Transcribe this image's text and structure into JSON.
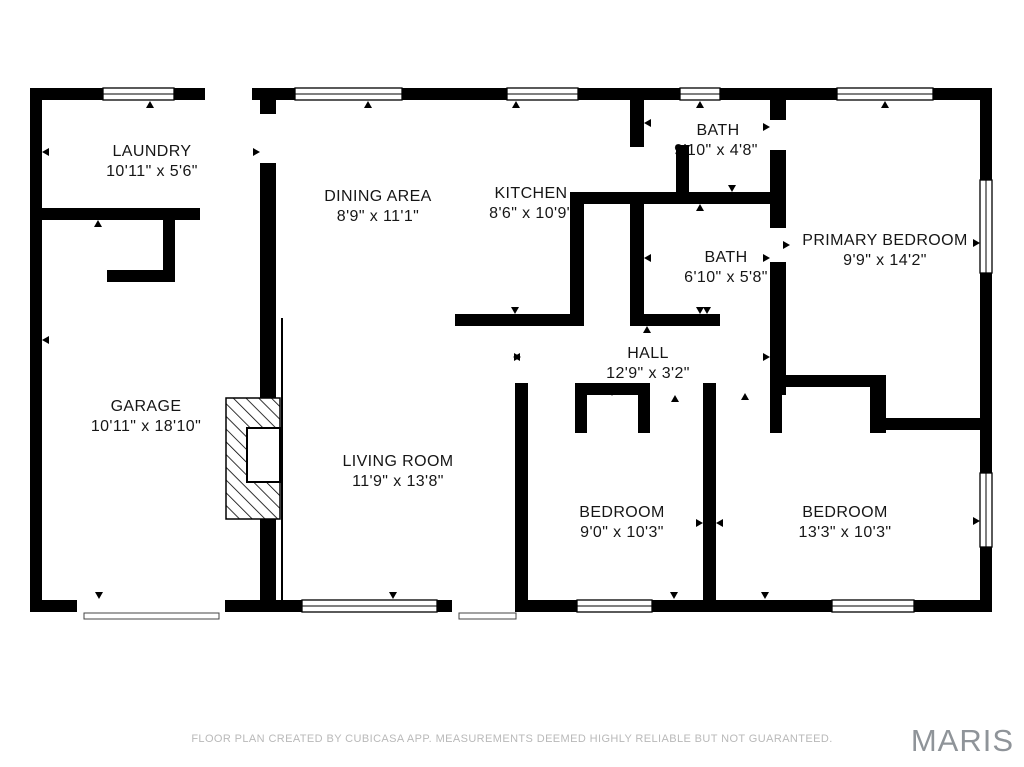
{
  "meta": {
    "footer": "FLOOR PLAN CREATED BY CUBICASA APP. MEASUREMENTS DEEMED HIGHLY RELIABLE BUT NOT GUARANTEED.",
    "watermark": "MARIS"
  },
  "colors": {
    "background": "#ffffff",
    "wall": "#000000",
    "label_text": "#161616",
    "footer_text": "#b9b9b9",
    "watermark_text": "#8f9499"
  },
  "rooms": [
    {
      "name": "LAUNDRY",
      "dims": "10'11\" x 5'6\""
    },
    {
      "name": "DINING AREA",
      "dims": "8'9\" x 11'1\""
    },
    {
      "name": "KITCHEN",
      "dims": "8'6\" x 10'9\""
    },
    {
      "name": "BATH",
      "dims": "9'10\" x 4'8\""
    },
    {
      "name": "BATH",
      "dims": "6'10\" x 5'8\""
    },
    {
      "name": "PRIMARY BEDROOM",
      "dims": "9'9\" x 14'2\""
    },
    {
      "name": "HALL",
      "dims": "12'9\" x 3'2\""
    },
    {
      "name": "GARAGE",
      "dims": "10'11\" x 18'10\""
    },
    {
      "name": "LIVING ROOM",
      "dims": "11'9\" x 13'8\""
    },
    {
      "name": "BEDROOM",
      "dims": "9'0\" x 10'3\""
    },
    {
      "name": "BEDROOM",
      "dims": "13'3\" x 10'3\""
    }
  ]
}
